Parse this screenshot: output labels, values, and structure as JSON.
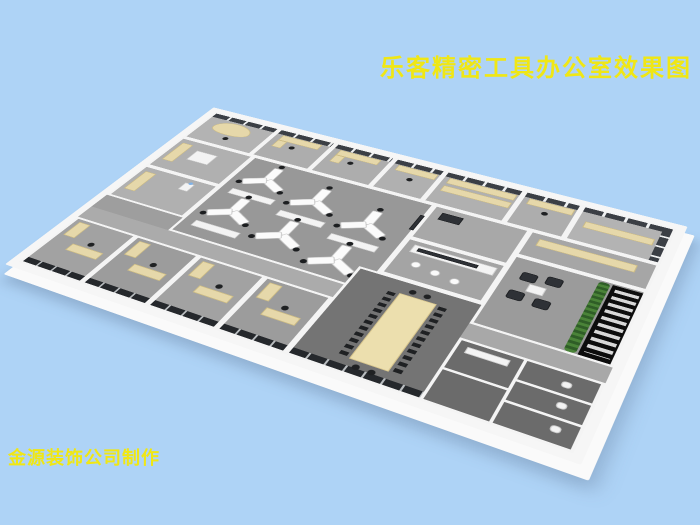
{
  "title": {
    "text": "乐客精密工具办公室效果图"
  },
  "credit": {
    "text": "金源装饰公司制作"
  },
  "palette": {
    "background": "#aed3f6",
    "caption_yellow": "#f0e714",
    "wall_white": "#f5f5f5",
    "floor_gray": "#9e9e9e",
    "conference_floor": "#747474",
    "washroom_floor": "#6b6b6b",
    "window_dark": "#3b3f45",
    "desk_beige": "#e6d8aa",
    "conference_table_beige": "#ecdfae",
    "chair_black": "#1f2123",
    "plant_green": "#4a8338",
    "stair_black": "#0d0d0d"
  },
  "scene": {
    "type": "3d-axonometric-office-floorplan-render",
    "rooms": [
      "corner-office-reception",
      "window-office-1",
      "window-office-2",
      "window-office-3",
      "storage-archive-room",
      "window-office-4",
      "corner-office-right",
      "side-room-1",
      "side-room-2",
      "open-office",
      "print-room",
      "pantry",
      "private-office-1",
      "private-office-2",
      "private-office-3",
      "private-office-4",
      "conference-room",
      "reception-counter-room",
      "lounge",
      "stairwell",
      "washrooms"
    ],
    "open_office_desk_clusters": 6,
    "desk_cluster_shape": "Y",
    "conference_seats": 28,
    "lounge_armchairs": 4,
    "pantry_stools": 3
  }
}
